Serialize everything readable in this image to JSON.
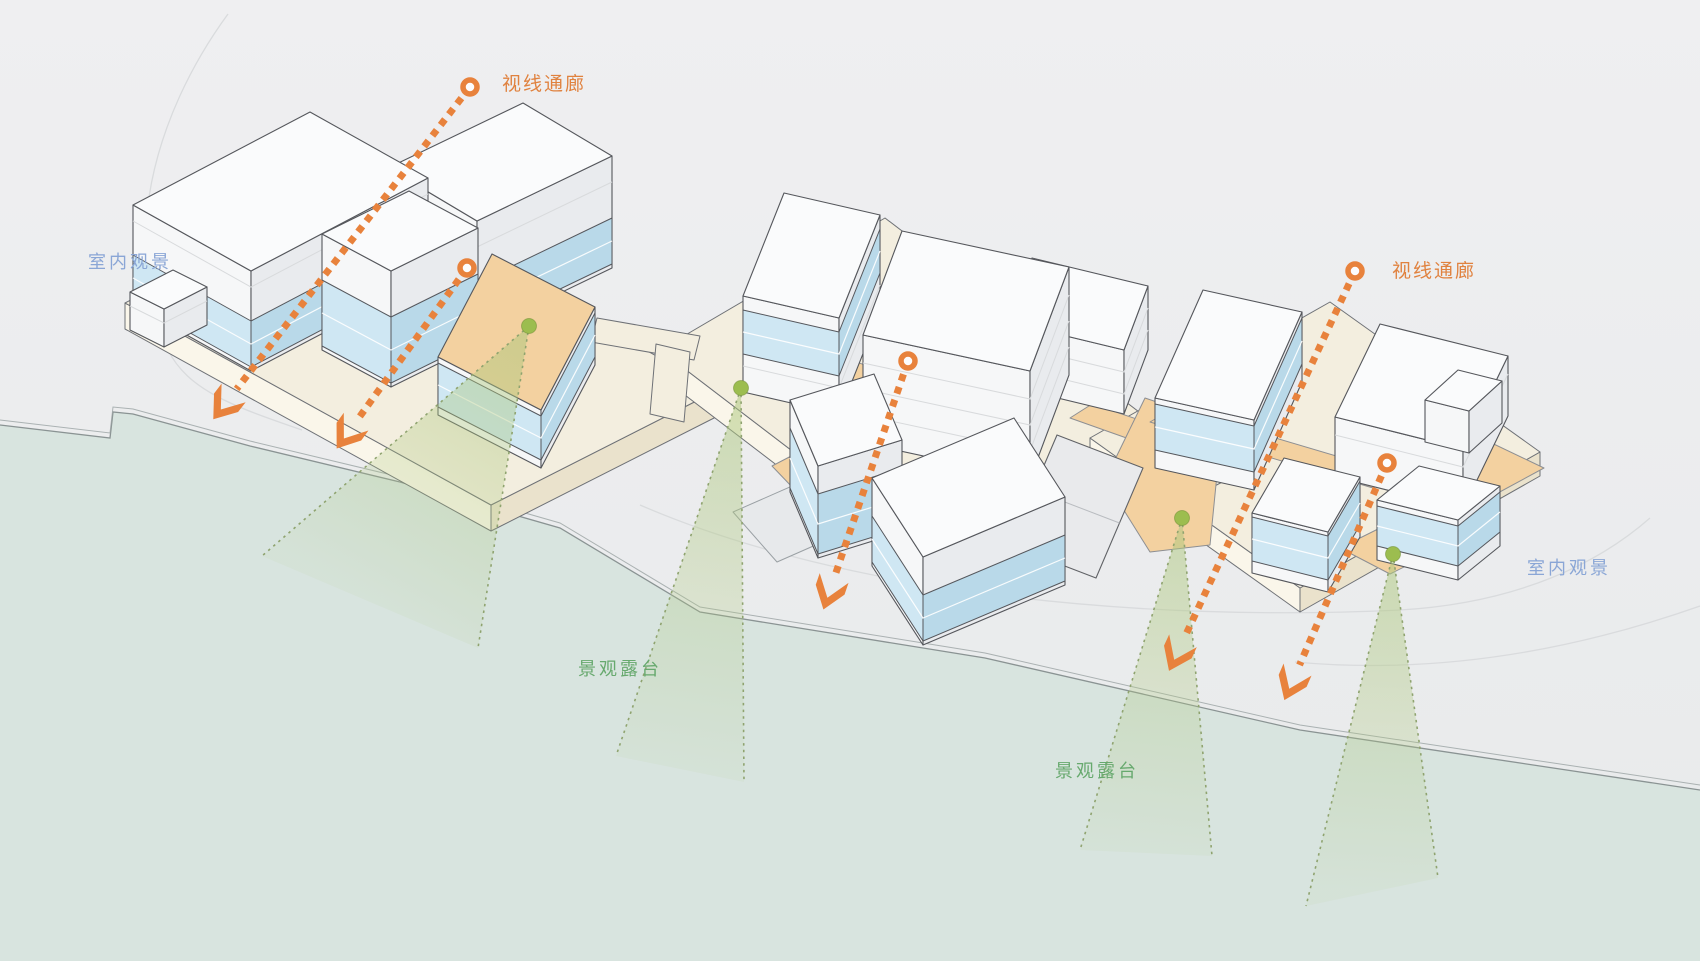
{
  "diagram": {
    "labels": {
      "sight_corridor": "视线通廊",
      "indoor_viewing": "室内观景",
      "landscape_terrace": "景观露台"
    },
    "colors": {
      "sight_corridor": "#e8823c",
      "sight_corridor_text": "#e0823f",
      "indoor_viewing_text": "#8aa6d6",
      "landscape_terrace_text": "#67a96e",
      "view_cone_fill": "#aec87e",
      "view_cone_edge": "#8fa36f",
      "view_point_dot": "#9cbd4f",
      "terrace_deck": "#f3d1a0",
      "glass_band_light": "#cfe7f3",
      "glass_band_dark": "#b9d9e9",
      "plinth": "#f3eedf",
      "building_top": "#fafbfc",
      "building_outline": "#55575c",
      "water": "#d8e4df",
      "land": "#ecedef"
    }
  }
}
